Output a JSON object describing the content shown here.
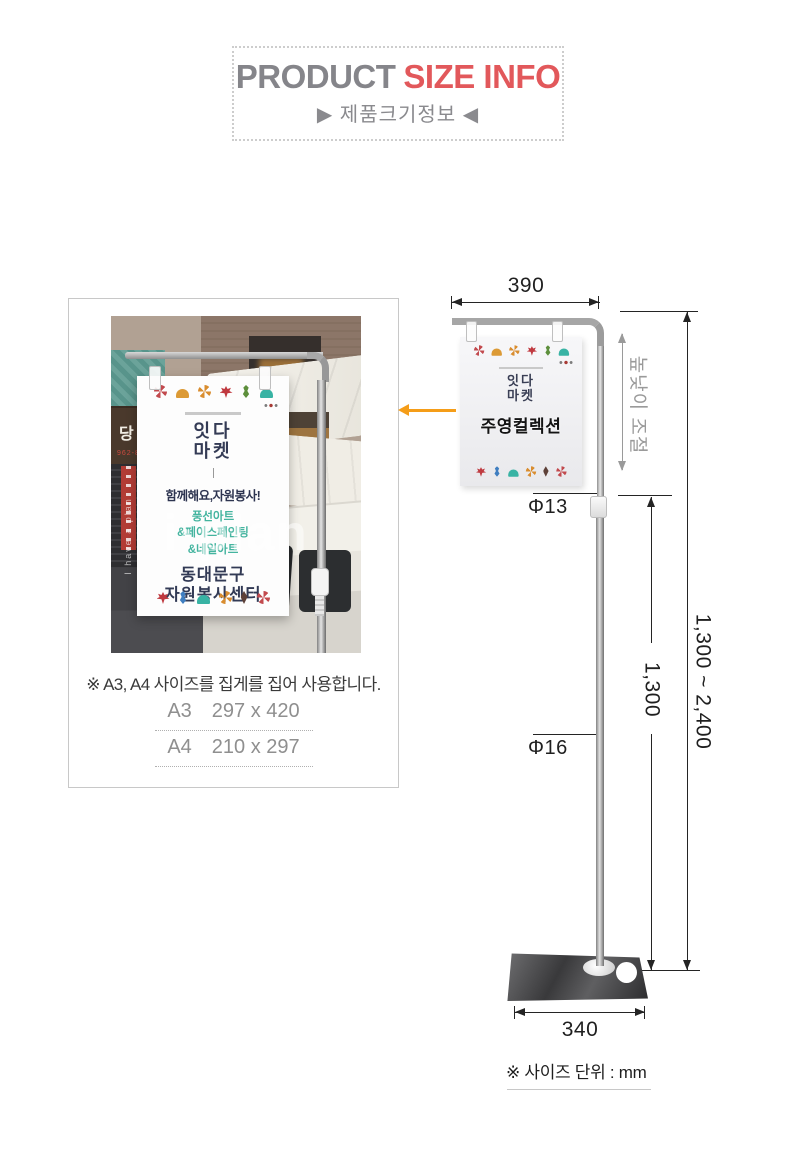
{
  "colors": {
    "accent_orange": "#f59d18",
    "title_red": "#e2585b",
    "title_gray": "#85858a"
  },
  "header": {
    "title_gray": "PRODUCT",
    "title_red": "SIZE INFO",
    "subtitle": "▶ 제품크기정보 ◀"
  },
  "photo": {
    "sign_text": "당한의원",
    "sign_phone": "962-8000",
    "poster": {
      "logo_line1": "잇다",
      "logo_line2": "마켓",
      "slogan": "함께해요,자원봉사!",
      "service1": "풍선아트",
      "service2": "&페이스페인팅",
      "service3": "&네일아트",
      "org1": "동대문구",
      "org2": "자원봉사센터"
    },
    "watermark": "i·plan",
    "watermark_side": "I have a plan"
  },
  "info": {
    "caption": "※ A3, A4 사이즈를 집게를 집어 사용합니다.",
    "paper_sizes": [
      {
        "name": "A3",
        "size": "297 x 420"
      },
      {
        "name": "A4",
        "size": "210 x 297"
      }
    ]
  },
  "diagram": {
    "poster": {
      "logo_line1": "잇다",
      "logo_line2": "마켓",
      "title": "주영컬렉션"
    },
    "dim_top_width": "390",
    "dim_height_adjust": "높낮이 조절",
    "dim_upper_diameter": "Φ13",
    "dim_lower_diameter": "Φ16",
    "dim_pole_height": "1,300",
    "dim_total_height": "1,300 ~ 2,400",
    "dim_base_width": "340",
    "unit_note": "※ 사이즈 단위 : mm"
  },
  "decorations": {
    "photo_top": [
      {
        "type": "pinwheel",
        "color": "#c24a4e"
      },
      {
        "type": "ginkgo",
        "color": "#dc9a35"
      },
      {
        "type": "pinwheel",
        "color": "#d98d2f"
      },
      {
        "type": "maple",
        "color": "#c0393f"
      },
      {
        "type": "oak",
        "color": "#5d8f3c"
      },
      {
        "type": "ginkgo",
        "color": "#38b3a4"
      }
    ],
    "photo_bottom": [
      {
        "type": "maple",
        "color": "#bf3a40"
      },
      {
        "type": "oak",
        "color": "#3f7ec0"
      },
      {
        "type": "ginkgo",
        "color": "#38b3a4"
      },
      {
        "type": "pinwheel",
        "color": "#d98d2f"
      },
      {
        "type": "leaf",
        "color": "#5d4038"
      },
      {
        "type": "pinwheel",
        "color": "#c24a4e"
      }
    ],
    "diagram_top": [
      {
        "type": "pinwheel",
        "color": "#c24a4e"
      },
      {
        "type": "ginkgo",
        "color": "#dc9a35"
      },
      {
        "type": "pinwheel",
        "color": "#d98d2f"
      },
      {
        "type": "maple",
        "color": "#c0393f"
      },
      {
        "type": "oak",
        "color": "#5d8f3c"
      },
      {
        "type": "ginkgo",
        "color": "#38b3a4"
      }
    ],
    "diagram_bottom": [
      {
        "type": "maple",
        "color": "#bf3a40"
      },
      {
        "type": "oak",
        "color": "#3f7ec0"
      },
      {
        "type": "ginkgo",
        "color": "#38b3a4"
      },
      {
        "type": "pinwheel",
        "color": "#d98d2f"
      },
      {
        "type": "leaf",
        "color": "#5d4038"
      },
      {
        "type": "pinwheel",
        "color": "#c24a4e"
      }
    ]
  }
}
